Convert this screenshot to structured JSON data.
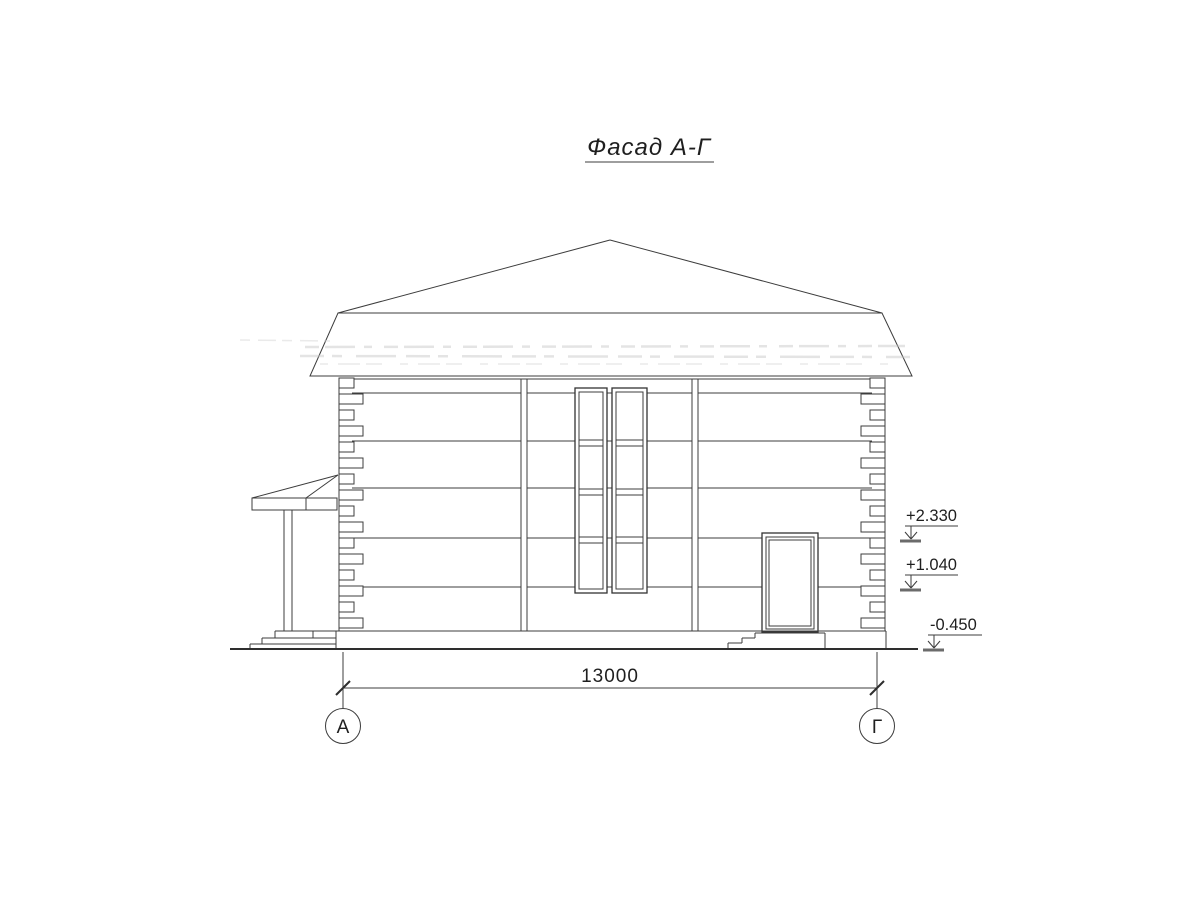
{
  "title": "Фасад А-Г",
  "dimension": {
    "value": "13000"
  },
  "axes": [
    {
      "label": "А"
    },
    {
      "label": "Г"
    }
  ],
  "elevation_marks": [
    {
      "value": "+2.330"
    },
    {
      "value": "+1.040"
    },
    {
      "value": "-0.450"
    }
  ],
  "colors": {
    "ink": "#3c3c3c",
    "paper": "#ffffff"
  }
}
